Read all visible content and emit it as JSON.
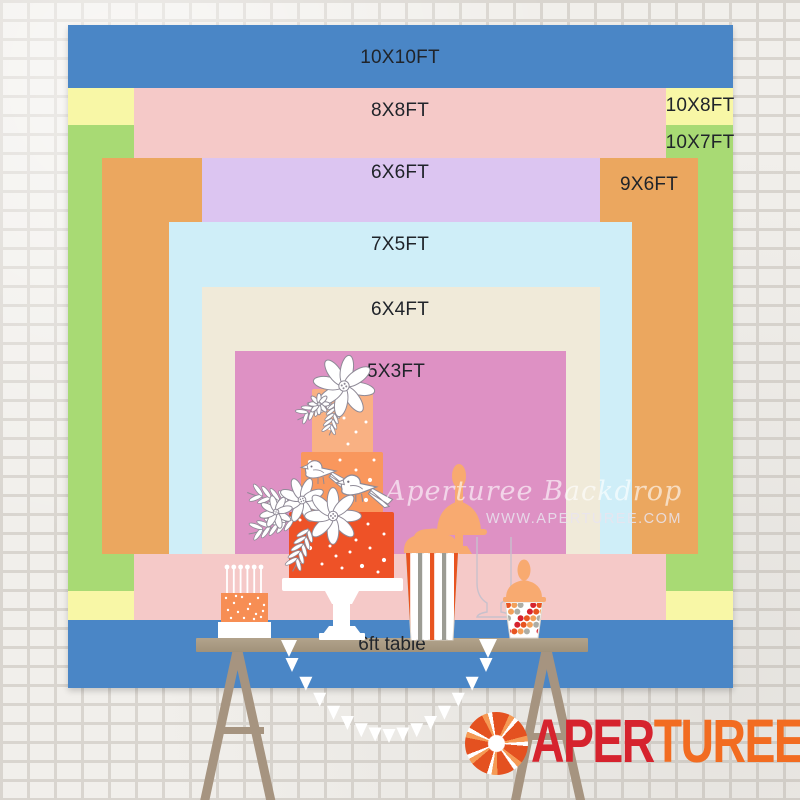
{
  "diagram": {
    "description": "Backdrop size comparison chart",
    "sizes": {
      "s10x10": {
        "label": "10X10FT",
        "color": "#4a86c6",
        "width_ft": 10,
        "height_ft": 10
      },
      "s8x8": {
        "label": "8X8FT",
        "color": "#f5c9c8",
        "width_ft": 8,
        "height_ft": 8
      },
      "s10x8": {
        "label": "10X8FT",
        "color": "#f8f7a6",
        "width_ft": 10,
        "height_ft": 8
      },
      "s10x7": {
        "label": "10X7FT",
        "color": "#a8da74",
        "width_ft": 10,
        "height_ft": 7
      },
      "s9x6": {
        "label": "9X6FT",
        "color": "#eba75f",
        "width_ft": 9,
        "height_ft": 6
      },
      "s6x6": {
        "label": "6X6FT",
        "color": "#dcc5f1",
        "width_ft": 6,
        "height_ft": 6
      },
      "s7x5": {
        "label": "7X5FT",
        "color": "#cfeef8",
        "width_ft": 7,
        "height_ft": 5
      },
      "s6x4": {
        "label": "6X4FT",
        "color": "#f0ead9",
        "width_ft": 6,
        "height_ft": 4
      },
      "s5x3": {
        "label": "5X3FT",
        "color": "#de91c4",
        "width_ft": 5,
        "height_ft": 3
      }
    },
    "table": {
      "label": "6ft table",
      "color": "#ac9d86"
    }
  },
  "watermark": {
    "script": "Aperturee Backdrop",
    "site": "WWW.APERTUREE.COM"
  },
  "logo": {
    "part1": "APER",
    "part2": "TUREE",
    "part1_color": "#d6232e",
    "part2_color": "#f26c21"
  }
}
